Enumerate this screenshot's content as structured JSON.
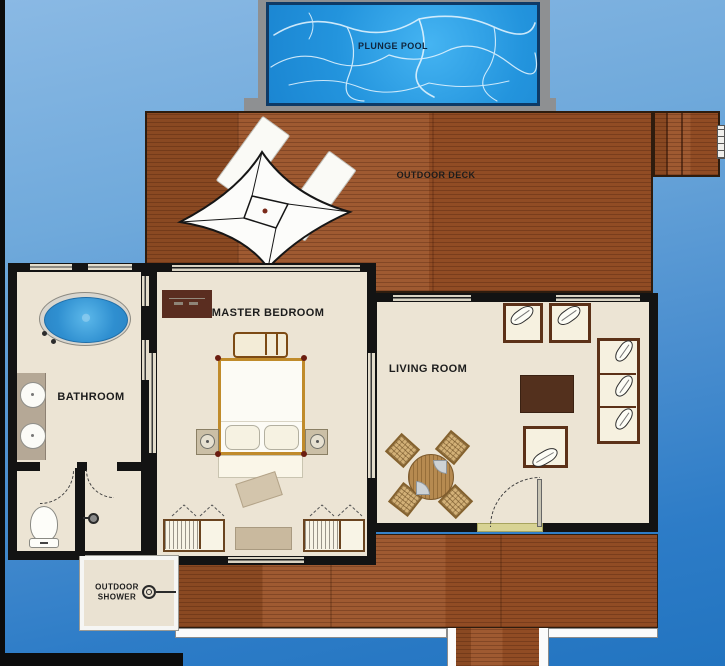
{
  "plan": {
    "kind": "overwater-villa-floor-plan",
    "labels": {
      "plunge_pool": "PLUNGE POOL",
      "outdoor_deck": "OUTDOOR DECK",
      "bathroom": "BATHROOM",
      "master_bedroom": "MASTER BEDROOM",
      "living_room": "LIVING ROOM",
      "outdoor_shower": "OUTDOOR SHOWER"
    },
    "rooms": [
      {
        "id": "plunge-pool"
      },
      {
        "id": "outdoor-deck"
      },
      {
        "id": "bathroom"
      },
      {
        "id": "master-bedroom"
      },
      {
        "id": "living-room"
      },
      {
        "id": "outdoor-shower"
      }
    ],
    "icons": [
      "parasol-icon",
      "sun-lounger-icon",
      "bathtub-icon",
      "sink-icon",
      "toilet-icon",
      "shower-head-icon",
      "bed-icon",
      "wardrobe-icon",
      "sofa-icon",
      "armchair-icon",
      "dining-table-icon",
      "coffee-table-icon",
      "deck-steps-icon",
      "door-swing-icon"
    ],
    "colors": {
      "water_top": "#8ab9e4",
      "water_bottom": "#2274c0",
      "pool_water": "#2ba2e8",
      "pool_surround": "#8e9092",
      "deck_wood": "#9a5126",
      "room_floor": "#ece4d4",
      "wall": "#131313",
      "bed_frame": "#c08b2b",
      "dark_furniture": "#57301d",
      "threshold": "#d8d394"
    }
  }
}
